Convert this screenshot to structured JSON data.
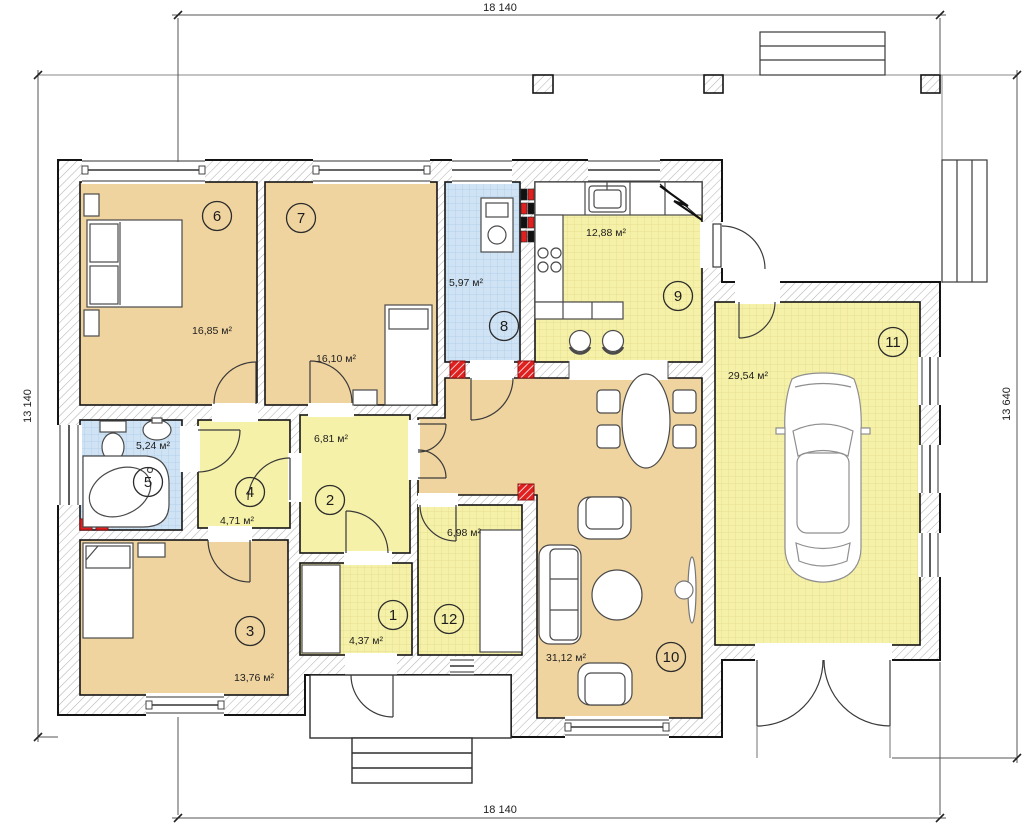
{
  "plan": {
    "type": "house-floor-plan",
    "dimensions": {
      "top": "18 140",
      "bottom": "18 140",
      "left": "13 140",
      "right": "13 640"
    },
    "rooms": [
      {
        "number": "1",
        "area": "4,37 м²"
      },
      {
        "number": "2",
        "area": "6,81 м²"
      },
      {
        "number": "3",
        "area": "13,76 м²"
      },
      {
        "number": "4",
        "area": "4,71 м²"
      },
      {
        "number": "5",
        "area": "5,24 м²"
      },
      {
        "number": "6",
        "area": "16,85 м²"
      },
      {
        "number": "7",
        "area": "16,10 м²"
      },
      {
        "number": "8",
        "area": "5,97 м²"
      },
      {
        "number": "9",
        "area": "12,88 м²"
      },
      {
        "number": "10",
        "area": "31,12 м²"
      },
      {
        "number": "11",
        "area": "29,54 м²"
      },
      {
        "number": "12",
        "area": "6,98 м²"
      }
    ],
    "colors": {
      "room_tan": "#f0d4a0",
      "room_yellow": "#f6f1a8",
      "room_blue": "#cfe3f4",
      "wall_line": "#141414",
      "vent_red": "#e01f1f"
    }
  }
}
